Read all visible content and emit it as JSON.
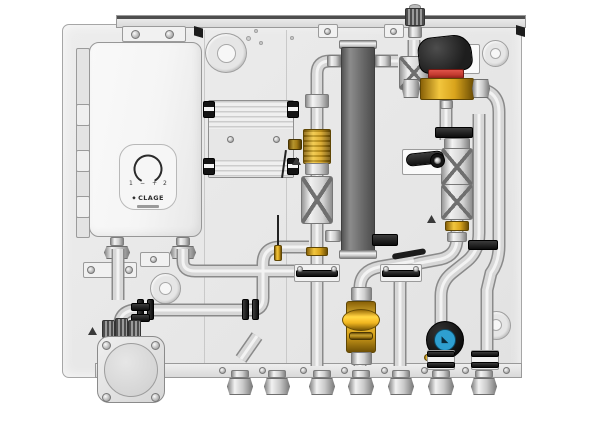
{
  "heater": {
    "brand": "CLAGE",
    "dial_labels": {
      "left_num": "1",
      "minus": "−",
      "plus": "+",
      "right_num": "2"
    }
  },
  "icons": {
    "logo_mark": "◆",
    "pump_glyph": "◣"
  },
  "colors": {
    "panel": "#e9e9e9",
    "panel_border": "#a6a6a6",
    "heater": "#f5f5f5",
    "hx": "#6d6d6d",
    "brass": "#d9a41c",
    "brass_dark": "#8a6208",
    "red": "#c23a2e",
    "black": "#1e1e1e",
    "blue": "#2e9fd1",
    "pipe": "#d7d7d7",
    "pipe_edge": "#8a8a8a"
  }
}
